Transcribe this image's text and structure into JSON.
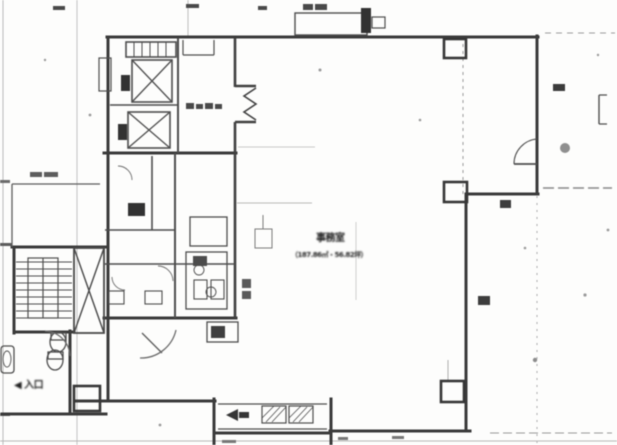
{
  "labels": {
    "office_name": "事務室",
    "office_area": "（187.86㎡・56.82坪）",
    "entrance": "◀ 入口"
  },
  "colors": {
    "ink_heavy": "#383838",
    "ink_medium": "#4b4b4b",
    "ink_faint": "#b5b5b5",
    "paper": "#fdfdfc"
  }
}
